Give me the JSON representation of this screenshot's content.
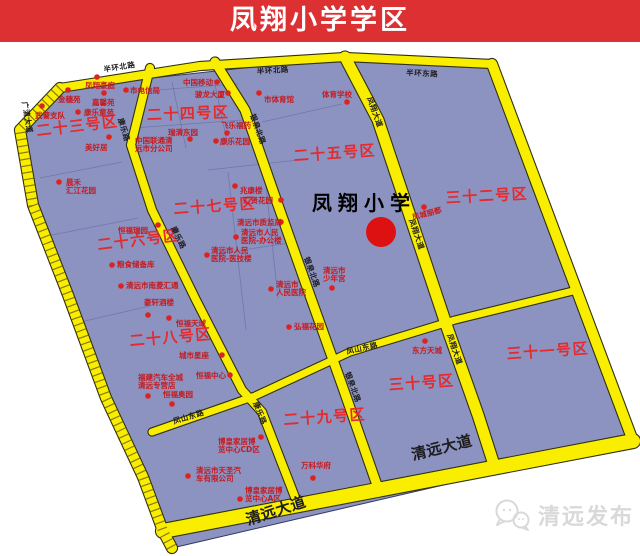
{
  "banner": {
    "title": "凤翔小学学区",
    "bg": "#dc3032",
    "fg": "#ffffff"
  },
  "watermark": {
    "text": "清远发布",
    "icon": "wechat-bubbles-icon",
    "color": "#d9d9d9"
  },
  "map": {
    "colors": {
      "zone_fill": "#8d93c1",
      "zone_edge": "#34395e",
      "road_fill": "#f9ee00",
      "road_edge": "#30300f",
      "road_tick": "#6b5e07",
      "detail_line": "#4d5490",
      "zone_label": "#e42a2d",
      "poi_text": "#c51a1f",
      "poi_dot": "#dd2222",
      "road_label": "#1c1c1c",
      "school_text": "#000000",
      "school_dot": "#dd1111"
    },
    "outline": [
      [
        60,
        88
      ],
      [
        345,
        57
      ],
      [
        492,
        64
      ],
      [
        633,
        441
      ],
      [
        172,
        548
      ],
      [
        163,
        531
      ],
      [
        143,
        477
      ],
      [
        106,
        398
      ],
      [
        68,
        295
      ],
      [
        33,
        205
      ],
      [
        20,
        130
      ]
    ],
    "roads": [
      {
        "name": "west-boundary-road",
        "points": [
          [
            60,
            88
          ],
          [
            20,
            130
          ],
          [
            33,
            205
          ],
          [
            68,
            295
          ],
          [
            106,
            398
          ],
          [
            143,
            477
          ],
          [
            163,
            531
          ],
          [
            172,
            548
          ]
        ],
        "width": 10,
        "ticks": true
      },
      {
        "name": "banhuan-north-road",
        "points": [
          [
            60,
            88
          ],
          [
            200,
            66
          ],
          [
            345,
            57
          ],
          [
            492,
            64
          ]
        ],
        "width": 8
      },
      {
        "name": "northeast-boundary-road",
        "points": [
          [
            492,
            64
          ],
          [
            633,
            441
          ]
        ],
        "width": 10
      },
      {
        "name": "qingyuan-avenue",
        "points": [
          [
            163,
            531
          ],
          [
            633,
            441
          ]
        ],
        "width": 14
      },
      {
        "name": "kangle-road",
        "points": [
          [
            150,
            68
          ],
          [
            131,
            145
          ],
          [
            152,
            210
          ],
          [
            196,
            300
          ],
          [
            242,
            390
          ],
          [
            262,
            412
          ],
          [
            298,
            505
          ]
        ],
        "width": 8
      },
      {
        "name": "yinquan-north-road",
        "points": [
          [
            215,
            62
          ],
          [
            245,
            110
          ],
          [
            278,
            205
          ],
          [
            308,
            290
          ],
          [
            342,
            385
          ],
          [
            378,
            488
          ]
        ],
        "width": 9
      },
      {
        "name": "fengxiang-avenue",
        "points": [
          [
            345,
            57
          ],
          [
            378,
            120
          ],
          [
            412,
            222
          ],
          [
            448,
            330
          ],
          [
            478,
            415
          ],
          [
            495,
            468
          ]
        ],
        "width": 11
      },
      {
        "name": "fengshan-east-road",
        "points": [
          [
            152,
            432
          ],
          [
            255,
            396
          ],
          [
            350,
            352
          ],
          [
            455,
            320
          ],
          [
            577,
            290
          ]
        ],
        "width": 7
      }
    ],
    "detail_lines": [
      [
        [
          128,
          92
        ],
        [
          238,
          84
        ]
      ],
      [
        [
          133,
          128
        ],
        [
          243,
          120
        ]
      ],
      [
        [
          172,
          82
        ],
        [
          186,
          148
        ]
      ],
      [
        [
          214,
          80
        ],
        [
          228,
          146
        ]
      ],
      [
        [
          40,
          178
        ],
        [
          122,
          162
        ]
      ],
      [
        [
          52,
          235
        ],
        [
          138,
          218
        ]
      ],
      [
        [
          208,
          170
        ],
        [
          298,
          160
        ]
      ],
      [
        [
          216,
          254
        ],
        [
          296,
          242
        ]
      ],
      [
        [
          228,
          172
        ],
        [
          246,
          330
        ]
      ],
      [
        [
          264,
          168
        ],
        [
          278,
          298
        ]
      ],
      [
        [
          80,
          322
        ],
        [
          150,
          306
        ]
      ],
      [
        [
          262,
          122
        ],
        [
          342,
          104
        ]
      ]
    ],
    "zone_labels": [
      {
        "t": "二十三号区",
        "x": 37,
        "y": 136,
        "rot": -7
      },
      {
        "t": "二十四号区",
        "x": 147,
        "y": 120,
        "rot": -2
      },
      {
        "t": "二十五号区",
        "x": 294,
        "y": 161,
        "rot": -4
      },
      {
        "t": "三十二号区",
        "x": 446,
        "y": 203,
        "rot": -3
      },
      {
        "t": "二十七号区",
        "x": 174,
        "y": 214,
        "rot": -4
      },
      {
        "t": "二十六号区",
        "x": 98,
        "y": 250,
        "rot": -7
      },
      {
        "t": "二十八号区",
        "x": 130,
        "y": 346,
        "rot": -5
      },
      {
        "t": "二十九号区",
        "x": 284,
        "y": 425,
        "rot": -4
      },
      {
        "t": "三十号区",
        "x": 389,
        "y": 390,
        "rot": -4
      },
      {
        "t": "三十一号区",
        "x": 507,
        "y": 359,
        "rot": -4
      }
    ],
    "school": {
      "t": "凤翔小学",
      "x": 312,
      "y": 210,
      "size": 20,
      "dot": [
        381,
        232,
        15
      ]
    },
    "road_labels": [
      {
        "t": "半环北路",
        "x": 104,
        "y": 72,
        "rot": -9
      },
      {
        "t": "半环北路",
        "x": 257,
        "y": 74,
        "rot": -4
      },
      {
        "t": "半环东路",
        "x": 406,
        "y": 75,
        "rot": 3
      },
      {
        "t": "广清大道",
        "x": 22,
        "y": 102,
        "rot": 80
      },
      {
        "t": "康乐路",
        "x": 118,
        "y": 119,
        "rot": 73
      },
      {
        "t": "康乐路",
        "x": 171,
        "y": 228,
        "rot": 64
      },
      {
        "t": "康乐路",
        "x": 253,
        "y": 403,
        "rot": 68
      },
      {
        "t": "银泉北路",
        "x": 250,
        "y": 115,
        "rot": 70
      },
      {
        "t": "银泉北路",
        "x": 304,
        "y": 258,
        "rot": 70
      },
      {
        "t": "银泉北路",
        "x": 345,
        "y": 373,
        "rot": 70
      },
      {
        "t": "凤翔大道",
        "x": 367,
        "y": 98,
        "rot": 70
      },
      {
        "t": "凤翔大道",
        "x": 409,
        "y": 220,
        "rot": 71
      },
      {
        "t": "凤翔大道",
        "x": 447,
        "y": 335,
        "rot": 71
      },
      {
        "t": "凤山东路",
        "x": 174,
        "y": 424,
        "rot": -17
      },
      {
        "t": "凤山东路",
        "x": 347,
        "y": 354,
        "rot": -12
      },
      {
        "t": "清远大道",
        "x": 248,
        "y": 525,
        "rot": -18,
        "size": 15,
        "bold": true
      },
      {
        "t": "清远大道",
        "x": 413,
        "y": 460,
        "rot": -14,
        "size": 15,
        "bold": true
      }
    ],
    "pois": [
      {
        "t": [
          "凤翔豪庭"
        ],
        "x": 85,
        "y": 88,
        "dot": [
          97,
          77
        ]
      },
      {
        "t": [
          "金穗苑"
        ],
        "x": 58,
        "y": 102,
        "dot": [
          68,
          90
        ]
      },
      {
        "t": [
          "嘉馨苑"
        ],
        "x": 92,
        "y": 105,
        "dot": [
          104,
          93
        ]
      },
      {
        "t": [
          "武警支队"
        ],
        "x": 35,
        "y": 118,
        "dot": [
          42,
          106
        ]
      },
      {
        "t": [
          "康乐童苑"
        ],
        "x": 84,
        "y": 115,
        "dot": [
          78,
          112
        ]
      },
      {
        "t": [
          "美好居"
        ],
        "x": 85,
        "y": 150,
        "dot": [
          109,
          137
        ]
      },
      {
        "t": [
          "晨禾",
          "汇江花园"
        ],
        "x": 66,
        "y": 185,
        "dot": [
          59,
          182
        ]
      },
      {
        "t": [
          "市电信局"
        ],
        "x": 130,
        "y": 93,
        "dot": [
          126,
          90
        ]
      },
      {
        "t": [
          "中国移动"
        ],
        "x": 183,
        "y": 85,
        "dot": [
          217,
          82
        ]
      },
      {
        "t": [
          "骏龙大厦"
        ],
        "x": 195,
        "y": 97,
        "dot": [
          228,
          93
        ]
      },
      {
        "t": [
          "瑞清东园"
        ],
        "x": 168,
        "y": 135,
        "dot": [
          190,
          139
        ]
      },
      {
        "t": [
          "中国联通清",
          "远市分公司"
        ],
        "x": 135,
        "y": 143
      },
      {
        "t": [
          "飞乐福药"
        ],
        "x": 221,
        "y": 128,
        "dot": [
          227,
          133
        ]
      },
      {
        "t": [
          "康乐花园"
        ],
        "x": 220,
        "y": 144,
        "dot": [
          216,
          141
        ]
      },
      {
        "t": [
          "市体育馆"
        ],
        "x": 264,
        "y": 102,
        "dot": [
          259,
          93
        ]
      },
      {
        "t": [
          "体育学校"
        ],
        "x": 322,
        "y": 97,
        "dot": [
          347,
          102
        ]
      },
      {
        "t": [
          "凤城丽都"
        ],
        "x": 413,
        "y": 220,
        "dot": [
          424,
          207
        ],
        "rot": -15
      },
      {
        "t": [
          "兆康楼"
        ],
        "x": 240,
        "y": 193,
        "dot": [
          235,
          186
        ]
      },
      {
        "t": [
          "汇贤花园"
        ],
        "x": 243,
        "y": 203,
        "dot": [
          281,
          200
        ]
      },
      {
        "t": [
          "清远市质监局"
        ],
        "x": 237,
        "y": 225,
        "dot": [
          281,
          222
        ]
      },
      {
        "t": [
          "清远市人民",
          "医院-办公楼"
        ],
        "x": 241,
        "y": 235,
        "dot": [
          236,
          237
        ]
      },
      {
        "t": [
          "清远市人民",
          "医院-医技楼"
        ],
        "x": 211,
        "y": 253,
        "dot": [
          207,
          255
        ]
      },
      {
        "t": [
          "清远市",
          "人民医院"
        ],
        "x": 276,
        "y": 287,
        "dot": [
          271,
          289
        ]
      },
      {
        "t": [
          "清远市",
          "少年宫"
        ],
        "x": 323,
        "y": 273,
        "dot": [
          332,
          288
        ]
      },
      {
        "t": [
          "弘福花园"
        ],
        "x": 294,
        "y": 329,
        "dot": [
          289,
          327
        ]
      },
      {
        "t": [
          "恒福瑞园"
        ],
        "x": 118,
        "y": 233,
        "dot": [
          158,
          225
        ]
      },
      {
        "t": [
          "粮食储备库"
        ],
        "x": 117,
        "y": 267,
        "dot": [
          112,
          265
        ]
      },
      {
        "t": [
          "清远市南菱汇通"
        ],
        "x": 126,
        "y": 288,
        "dot": [
          121,
          286
        ]
      },
      {
        "t": [
          "豪轩酒楼"
        ],
        "x": 144,
        "y": 305,
        "dot": [
          148,
          315
        ]
      },
      {
        "t": [
          "恒福天域"
        ],
        "x": 176,
        "y": 326,
        "dot": [
          169,
          318
        ]
      },
      {
        "t": [
          "城市星座"
        ],
        "x": 179,
        "y": 358,
        "dot": [
          222,
          355
        ]
      },
      {
        "t": [
          "恒福中心"
        ],
        "x": 196,
        "y": 378,
        "dot": [
          230,
          375
        ]
      },
      {
        "t": [
          "福建汽车全城",
          "清远专营店"
        ],
        "x": 138,
        "y": 380,
        "dot": [
          148,
          396
        ]
      },
      {
        "t": [
          "恒福奥园"
        ],
        "x": 163,
        "y": 397,
        "dot": [
          172,
          404
        ]
      },
      {
        "t": [
          "博皇家居博",
          "览中心CD区"
        ],
        "x": 218,
        "y": 444,
        "dot": [
          261,
          437
        ]
      },
      {
        "t": [
          "清远市天圣汽",
          "车有限公司"
        ],
        "x": 196,
        "y": 473,
        "dot": [
          188,
          476
        ]
      },
      {
        "t": [
          "博皇家居博",
          "览中心A区"
        ],
        "x": 245,
        "y": 493,
        "dot": [
          240,
          499
        ]
      },
      {
        "t": [
          "万科华府"
        ],
        "x": 301,
        "y": 468,
        "dot": [
          313,
          478
        ]
      },
      {
        "t": [
          "东方天城"
        ],
        "x": 412,
        "y": 353,
        "dot": [
          425,
          341
        ]
      }
    ]
  }
}
